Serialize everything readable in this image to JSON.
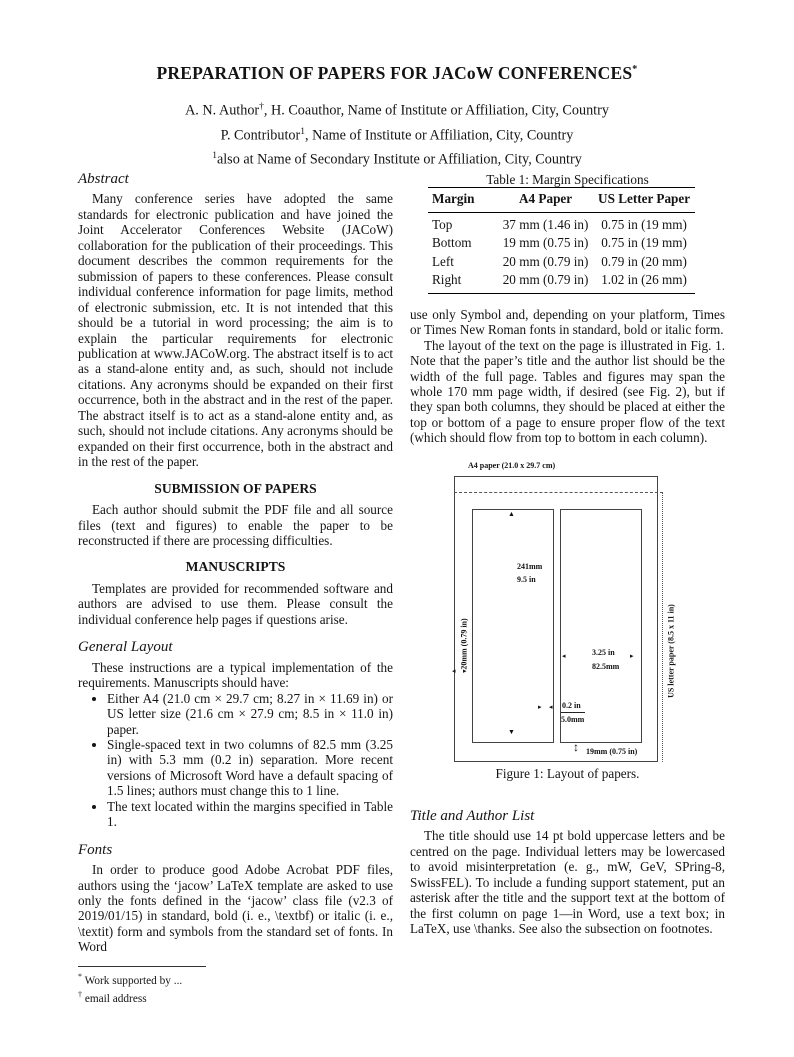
{
  "page": {
    "title": "PREPARATION OF PAPERS FOR JACoW CONFERENCES",
    "title_mark": "*",
    "authors": [
      {
        "pre": "A. N. Author",
        "sup": "†",
        "post": ", H. Coauthor, Name of Institute or Affiliation, City, Country"
      },
      {
        "pre": "P. Contributor",
        "sup": "1",
        "post": ", Name of Institute or Affiliation, City, Country"
      },
      {
        "pre": "",
        "sup": "1",
        "post": "also at Name of Secondary Institute or Affiliation, City, Country"
      }
    ]
  },
  "left_column": {
    "abstract_heading": "Abstract",
    "abstract_text": "Many conference series have adopted the same standards for electronic publication and have joined the Joint Accelerator Conferences Website (JACoW) collaboration for the publication of their proceedings. This document describes the common requirements for the submission of papers to these conferences. Please consult individual conference information for page limits, method of electronic submission, etc. It is not intended that this should be a tutorial in word processing; the aim is to explain the particular requirements for electronic publication at www.JACoW.org. The abstract itself is to act as a stand-alone entity and, as such, should not include citations. Any acronyms should be expanded on their first occurrence, both in the abstract and in the rest of the paper. The abstract itself is to act as a stand-alone entity and, as such, should not include citations. Any acronyms should be expanded on their first occurrence, both in the abstract and in the rest of the paper.",
    "submission_heading": "SUBMISSION OF PAPERS",
    "submission_text": "Each author should submit the PDF file and all source files (text and figures) to enable the paper to be reconstructed if there are processing difficulties.",
    "manuscripts_heading": "MANUSCRIPTS",
    "manuscripts_text": "Templates are provided for recommended software and authors are advised to use them. Please consult the individual conference help pages if questions arise.",
    "general_layout_heading": "General Layout",
    "general_layout_text": "These instructions are a typical implementation of the requirements. Manuscripts should have:",
    "bullets": [
      "Either A4 (21.0 cm × 29.7 cm; 8.27 in × 11.69 in) or US letter size (21.6 cm × 27.9 cm; 8.5 in × 11.0 in) paper.",
      "Single-spaced text in two columns of 82.5 mm (3.25 in) with 5.3 mm (0.2 in) separation. More recent versions of Microsoft Word have a default spacing of 1.5 lines; authors must change this to 1 line.",
      "The text located within the margins specified in Table 1."
    ],
    "fonts_heading": "Fonts",
    "fonts_text": "In order to produce good Adobe Acrobat PDF files, authors using the ‘jacow’ LaTeX template are asked to use only the fonts defined in the ‘jacow’ class file (v2.3 of 2019/01/15) in standard, bold (i. e., \\textbf) or italic (i. e., \\textit) form and symbols from the standard set of fonts. In Word",
    "footnotes": [
      {
        "marker": "*",
        "text": "Work supported by ..."
      },
      {
        "marker": "†",
        "text": "email address"
      }
    ]
  },
  "right_column": {
    "table": {
      "caption": "Table 1: Margin Specifications",
      "headers": [
        "Margin",
        "A4 Paper",
        "US Letter Paper"
      ],
      "rows": [
        [
          "Top",
          "37 mm (1.46 in)",
          "0.75 in (19 mm)"
        ],
        [
          "Bottom",
          "19 mm (0.75 in)",
          "0.75 in (19 mm)"
        ],
        [
          "Left",
          "20 mm (0.79 in)",
          "0.79 in (20 mm)"
        ],
        [
          "Right",
          "20 mm (0.79 in)",
          "1.02 in (26 mm)"
        ]
      ]
    },
    "para1": "use only Symbol and, depending on your platform, Times or Times New Roman fonts in standard, bold or italic form.",
    "para2": "The layout of the text on the page is illustrated in Fig. 1. Note that the paper’s title and the author list should be the width of the full page. Tables and figures may span the whole 170 mm page width, if desired (see Fig. 2), but if they span both columns, they should be placed at either the top or bottom of a page to ensure proper flow of the text (which should flow from top to bottom in each column).",
    "figure": {
      "a4_label": "A4 paper (21.0 x 29.7 cm)",
      "us_letter_label": "US letter paper (8.5 x 11 in)",
      "col_height_line1": "241mm",
      "col_height_line2": "9.5 in",
      "left_margin_label": "20mm (0.79 in)",
      "col_width_line1": "3.25 in",
      "col_width_line2": "82.5mm",
      "gap_line1": "0.2 in",
      "gap_line2": "5.0mm",
      "bottom_margin_label": "19mm (0.75 in)",
      "caption": "Figure 1: Layout of papers.",
      "up_arrow": "▲",
      "down_arrow": "▼",
      "left_arrow": "◂",
      "right_arrow": "▸",
      "vert_arrow": "↕"
    },
    "title_author_heading": "Title and Author List",
    "title_author_text": "The title should use 14 pt bold uppercase letters and be centred on the page. Individual letters may be lowercased to avoid misinterpretation (e. g., mW, GeV, SPring-8, SwissFEL). To include a funding support statement, put an asterisk after the title and the support text at the bottom of the first column on page 1—in Word, use a text box; in LaTeX, use \\thanks. See also the subsection on footnotes."
  }
}
